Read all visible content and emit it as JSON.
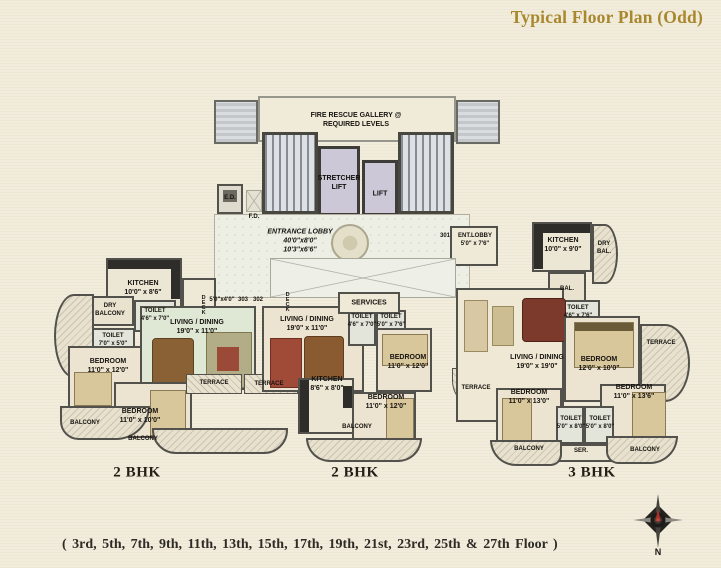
{
  "title": "Typical Floor Plan (Odd)",
  "floors_note": "( 3rd, 5th, 7th, 9th, 11th, 13th, 15th, 17th, 19th, 21st, 23rd, 25th & 27th Floor )",
  "units": {
    "left": "2 BHK",
    "middle": "2 BHK",
    "right": "3 BHK"
  },
  "compass": {
    "north": "N"
  },
  "colors": {
    "title_accent": "#a8872d",
    "wall": "#53514b",
    "background": "#f1ecdb",
    "lift_fill": "#ccc8d7"
  },
  "core": {
    "fire_rescue_gallery": "FIRE RESCUE GALLERY @\nREQUIRED LEVELS",
    "stretcher_lift": "STRETCHER\nLIFT",
    "lift": "LIFT",
    "ed": "E.D.",
    "fd": "F.D.",
    "entrance_lobby": "ENTRANCE LOBBY\n40'0\"x8'0\"\n10'3\"x6'6\"",
    "services": "SERVICES",
    "deck_dim": "5'0\"x4'0\"",
    "flat_303": "303",
    "flat_302": "302",
    "flat_301": "301"
  },
  "left_unit": {
    "kitchen": "KITCHEN\n10'0\" x 8'6\"",
    "dry_balcony": "DRY\nBALCONY",
    "toilet_a": "TOILET\n4'6\" x 7'0\"",
    "toilet_b": "TOILET\n7'0\" x 5'0\"",
    "bedroom_a": "BEDROOM\n11'0\" x 12'0\"",
    "living": "LIVING / DINING\n19'0\" x 11'0\"",
    "bedroom_b": "BEDROOM\n11'0\" x 10'0\"",
    "balcony_a": "BALCONY",
    "balcony_b": "BALCONY",
    "terrace": "TERRACE",
    "deck": "DECK"
  },
  "mid_unit": {
    "living": "LIVING / DINING\n19'0\" x 11'0\"",
    "toilet_a": "TOILET\n4'6\" x 7'0\"",
    "toilet_b": "TOILET\n5'0\" x 7'6\"",
    "kitchen": "KITCHEN\n8'6\" x 8'0\"",
    "bedroom_a": "BEDROOM\n11'0\" x 12'0\"",
    "bedroom_b": "BEDROOM\n11'0\" x 12'0\"",
    "balcony": "BALCONY",
    "terrace": "TERRACE",
    "deck": "DECK"
  },
  "right_unit": {
    "ent_lobby": "ENT.LOBBY\n5'0\" x 7'6\"",
    "kitchen": "KITCHEN\n10'0\" x 9'0\"",
    "dry_bal": "DRY\nBAL.",
    "bal": "BAL.",
    "toilet_top": "TOILET\n4'6\" x 7'6\"",
    "living": "LIVING / DINING\n19'0\" x 19'0\"",
    "bedroom_a": "BEDROOM\n12'0\" x 10'0\"",
    "terrace_left": "TERRACE",
    "terrace_right": "TERRACE",
    "bedroom_b": "BEDROOM\n11'0\" x 13'0\"",
    "bedroom_c": "BEDROOM\n11'0\" x 13'6\"",
    "toilet_a": "TOILET\n5'0\" x 8'0\"",
    "toilet_b": "TOILET\n5'0\" x 8'0\"",
    "ser": "SER.",
    "balcony_a": "BALCONY",
    "balcony_b": "BALCONY"
  }
}
